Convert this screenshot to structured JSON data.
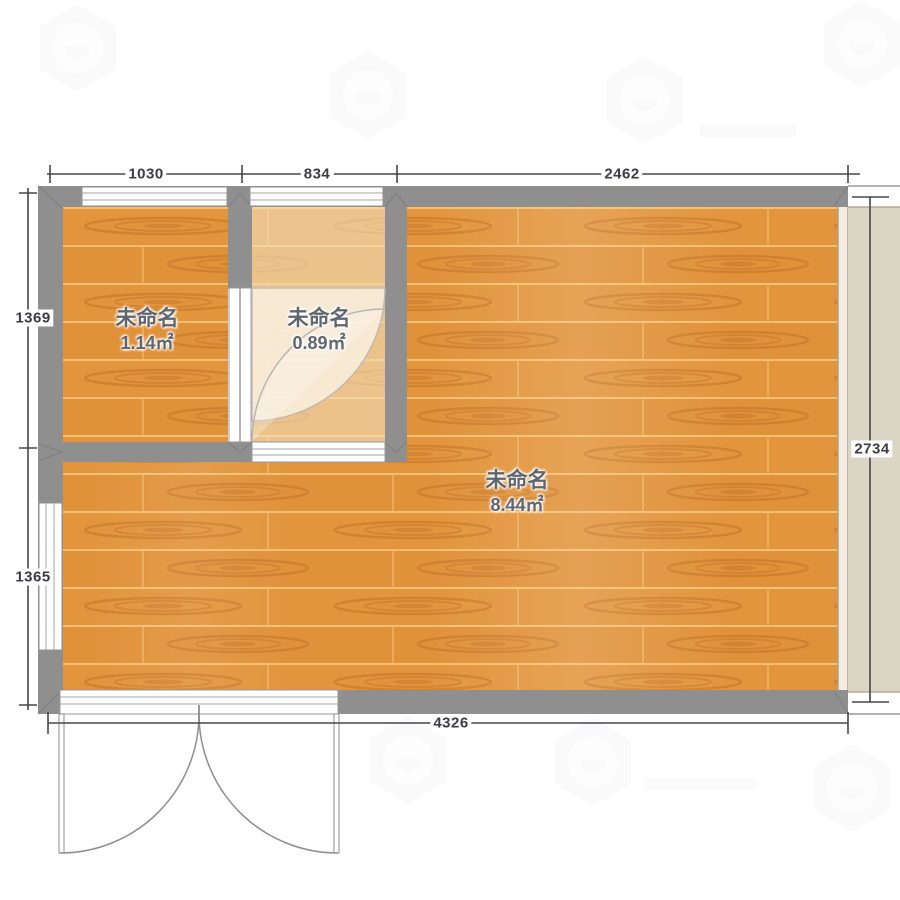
{
  "rooms": [
    {
      "name": "未命名",
      "area": "1.14㎡"
    },
    {
      "name": "未命名",
      "area": "0.89㎡"
    },
    {
      "name": "未命名",
      "area": "8.44㎡"
    }
  ],
  "dimensions": {
    "top": [
      "1030",
      "834",
      "2462"
    ],
    "left": [
      "1369",
      "1365"
    ],
    "right": [
      "2734"
    ],
    "bottom": [
      "4326"
    ]
  },
  "colors": {
    "wall": "#8f8f8f",
    "wood": "#e0923a",
    "wood_grain": "#bd6a20",
    "balcony_floor": "#dbd5c4",
    "dimension_line": "#45454b",
    "room_label_text": "#5f6670"
  }
}
